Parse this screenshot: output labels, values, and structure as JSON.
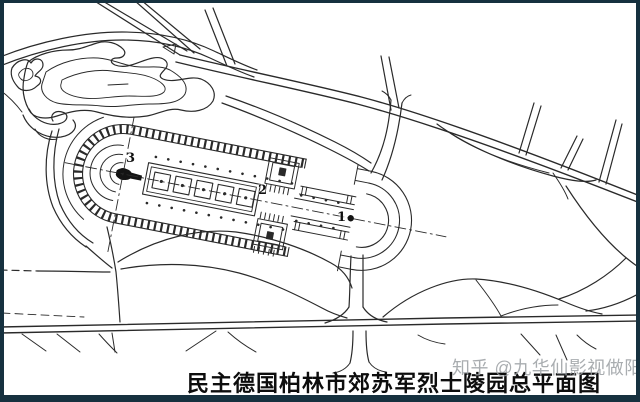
{
  "figure": {
    "caption": "民主德国柏林市郊苏军烈士陵园总平面图",
    "watermark": "知乎 @九华仙影视做阳",
    "markers": [
      {
        "text": "1"
      },
      {
        "text": "2"
      },
      {
        "text": "3"
      }
    ]
  },
  "map": {
    "kind": "hand-drawn site plan, scanned line drawing",
    "features": [
      "lake-with-contour-shorelines-upper-left",
      "diagonal-avenue-with-side-streets",
      "semicircular-memorial-mound-with-statue-marker-3",
      "five-square-burial-plots-on-central-axis",
      "twin-entrance-gates-marker-2",
      "circular-entrance-plaza-marker-1",
      "curving-park-paths",
      "boundary-road-along-bottom"
    ]
  },
  "colors": {
    "frame": "#16313f",
    "paper": "#ffffff",
    "ink": "#2a2a2a",
    "watermark": "#9b9fa3"
  }
}
